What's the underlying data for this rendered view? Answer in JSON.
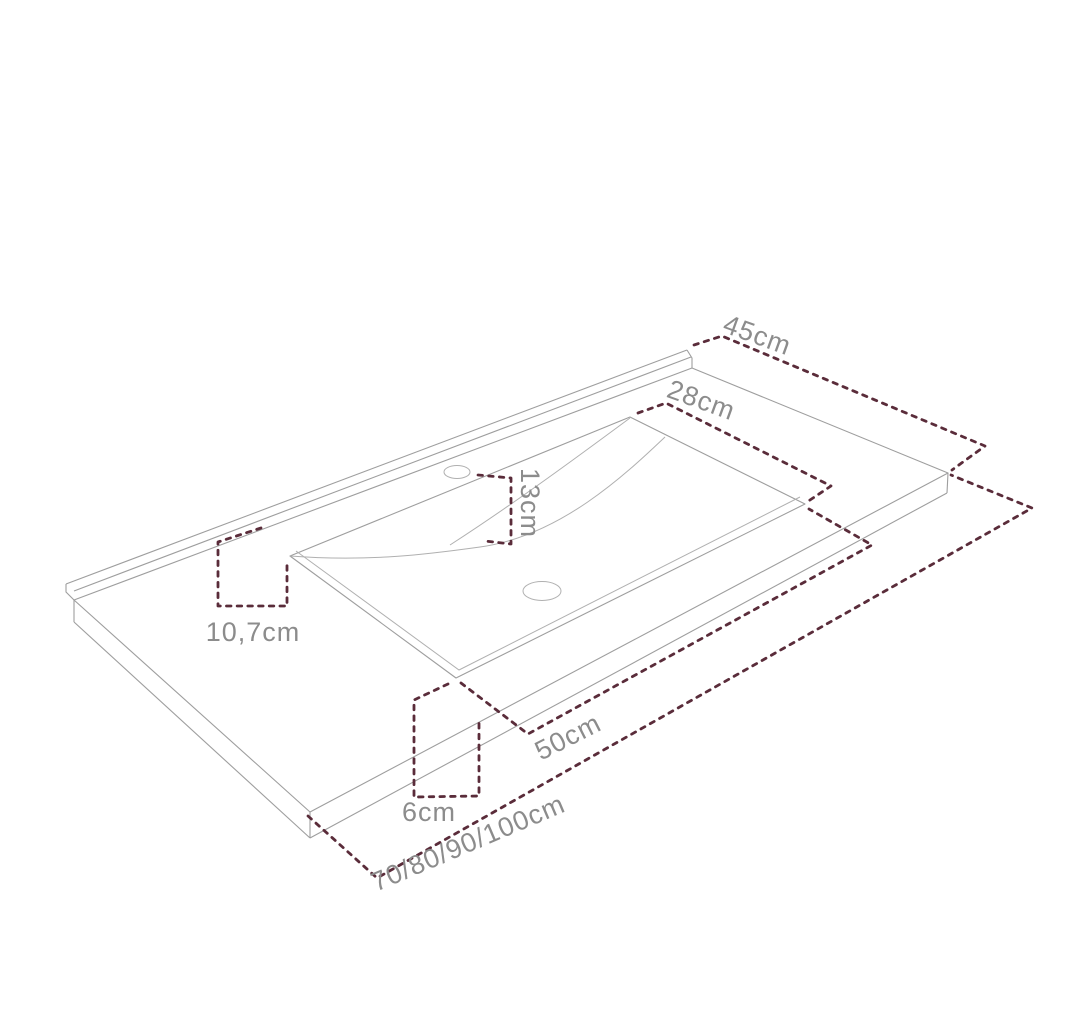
{
  "page": {
    "background": "#ffffff",
    "width": 1075,
    "height": 1017
  },
  "diagram": {
    "subject": "washbasin-countertop-technical-drawing",
    "colors": {
      "outline": "#9e9e9e",
      "dimension_line": "#5a2c3a",
      "label_text": "#8c8c8c"
    },
    "labels": {
      "depth": "45cm",
      "basin_depth": "28cm",
      "faucet_offset": "13cm",
      "back_offset": "10,7cm",
      "basin_width": "50cm",
      "height": "6cm",
      "total_width": "70/80/90/100cm"
    }
  }
}
